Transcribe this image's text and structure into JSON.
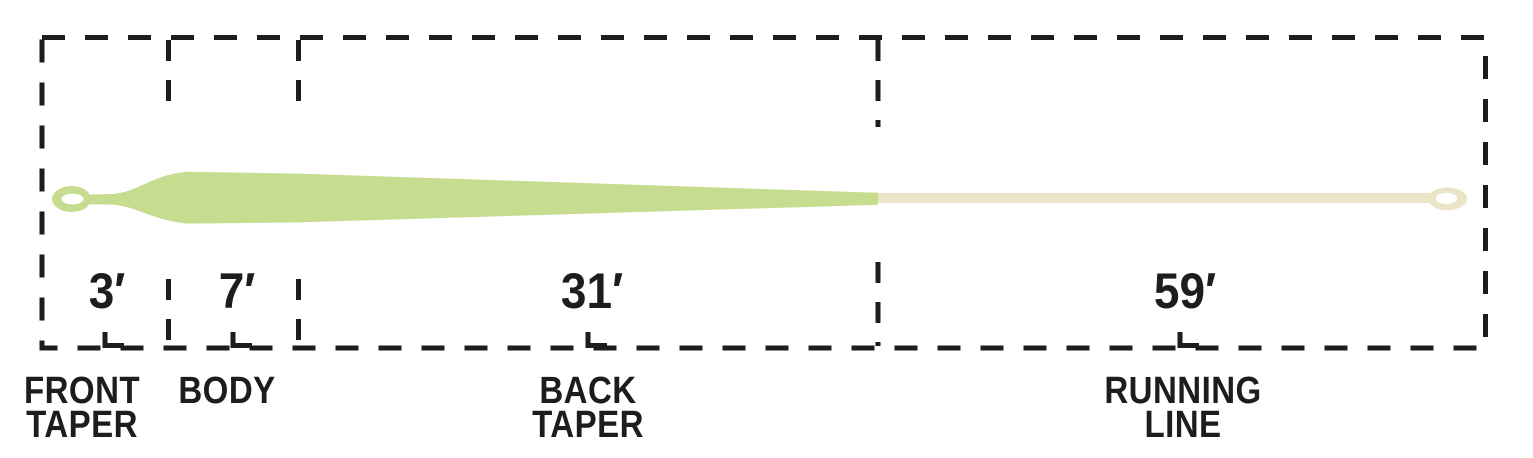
{
  "diagram": {
    "sections": [
      {
        "length_label": "3′",
        "length_ft": 3,
        "name_lines": [
          "FRONT",
          "TAPER"
        ]
      },
      {
        "length_label": "7′",
        "length_ft": 7,
        "name_lines": [
          "BODY"
        ]
      },
      {
        "length_label": "31′",
        "length_ft": 31,
        "name_lines": [
          "BACK",
          "TAPER"
        ]
      },
      {
        "length_label": "59′",
        "length_ft": 59,
        "name_lines": [
          "RUNNING",
          "LINE"
        ]
      }
    ],
    "colors": {
      "head_green": "#c6dc8f",
      "running_cream": "#ece4c6",
      "ink_black": "#1d1d1b",
      "loop_hole_white": "#ffffff"
    }
  }
}
